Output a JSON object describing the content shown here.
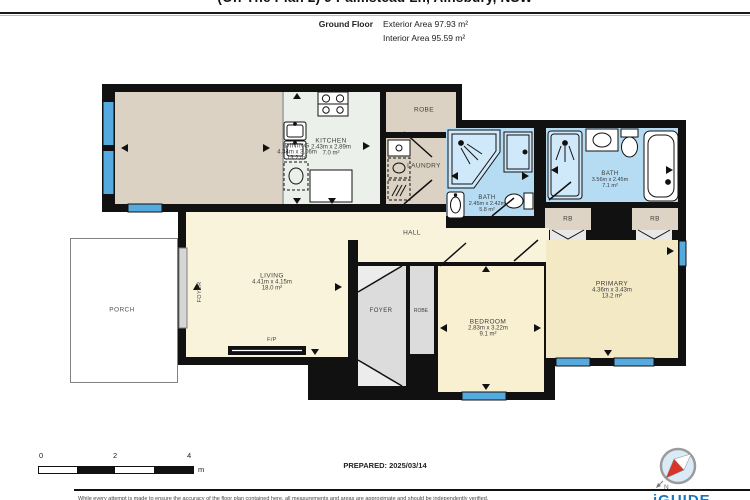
{
  "header": {
    "title_partial": "(Off The Plan 2) 9 Palmstead Ln, Ainsbury, NSW",
    "floor_label": "Ground Floor",
    "exterior_area": "Exterior Area 97.93 m²",
    "interior_area": "Interior Area 95.59 m²"
  },
  "rooms": {
    "dining": {
      "name": "DINING",
      "dims": "4.34m x 3.06m",
      "area": "13.2 m²"
    },
    "kitchen": {
      "name": "KITCHEN",
      "dims": "2.43m x 2.89m",
      "area": "7.0 m²"
    },
    "robe_top": {
      "name": "ROBE"
    },
    "laundry": {
      "name": "LAUNDRY"
    },
    "bath_main": {
      "name": "BATH",
      "dims": "2.45m x 2.42m",
      "area": "5.8 m²"
    },
    "bath_ensuite": {
      "name": "BATH",
      "dims": "3.56m x 2.45m",
      "area": "7.1 m²"
    },
    "rb_left": {
      "name": "RB"
    },
    "rb_right": {
      "name": "RB"
    },
    "hall": {
      "name": "HALL"
    },
    "living": {
      "name": "LIVING",
      "dims": "4.41m x 4.15m",
      "area": "18.0 m²"
    },
    "foyer_entry": {
      "name": "FOYER"
    },
    "foyer": {
      "name": "FOYER"
    },
    "robe_bedroom": {
      "name": "ROBE"
    },
    "bedroom": {
      "name": "BEDROOM",
      "dims": "2.83m x 3.22m",
      "area": "9.1 m²"
    },
    "primary": {
      "name": "PRIMARY",
      "dims": "4.36m x 3.43m",
      "area": "13.2 m²"
    },
    "porch": {
      "name": "PORCH"
    },
    "fireplace": {
      "name": "F/P"
    }
  },
  "compass": {
    "north_label": "N"
  },
  "icons": [
    "stove-icon",
    "kitchen-sink-icon",
    "fridge-icon",
    "washer-icon",
    "dryer-icon",
    "laundry-sink-icon",
    "shower-icon",
    "toilet-icon",
    "bathroom-sink-icon",
    "bathtub-icon",
    "fireplace-icon",
    "compass-icon"
  ],
  "footer": {
    "scale_ticks": [
      "0",
      "2",
      "4"
    ],
    "scale_unit": "m",
    "prepared": "PREPARED: 2025/03/14",
    "logo": "iGUIDE",
    "disclaimer_partial": "While every attempt is made to ensure the accuracy of the floor plan contained here, all measurements and areas are approximate and should be independently verified."
  },
  "colors": {
    "wall": "#111111",
    "window_blue": "#55abdf",
    "bath_floor": "#b5dcf2",
    "cream": "#faf3dc",
    "bedroom_cream": "#f9efd1",
    "primary_cream": "#f4e9c5",
    "beige": "#dcd2c3",
    "kitchen": "#ebf1ea",
    "gray_room": "#dcdcdc",
    "logo_blue": "#1b75bc"
  }
}
